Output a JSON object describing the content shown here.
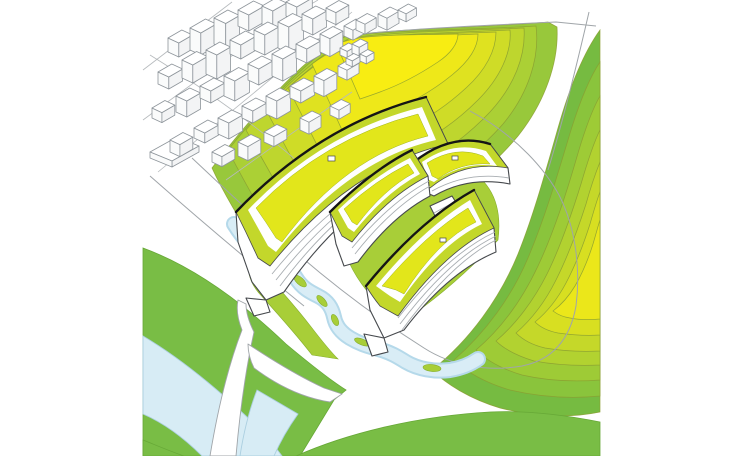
{
  "meta": {
    "title": "Architectural site-plan illustration",
    "description": "Axonometric diagram of four curved slab buildings with yellow-green roofs on a white plaza, set between two contoured hills, a small town, a winding creek and a branching riverside park",
    "visible_text": []
  },
  "scene": {
    "regions": [
      {
        "name": "town",
        "label": "white low-rise town blocks, upper left"
      },
      {
        "name": "north-hill",
        "label": "contoured hill, yellow peak fading to green"
      },
      {
        "name": "east-hill",
        "label": "contoured hill on the right, green edge to yellow peak"
      },
      {
        "name": "campus",
        "label": "four curved slab buildings with striped facades and chartreuse roofs"
      },
      {
        "name": "creek",
        "label": "winding light-blue creek with small green islands"
      },
      {
        "name": "river",
        "label": "wide light-blue river band, lower left"
      },
      {
        "name": "park",
        "label": "flat green park bands along roads"
      },
      {
        "name": "road-junction",
        "label": "white Y-shaped road branching through the park"
      }
    ]
  },
  "colors": {
    "canvasBg": "#ffffff",
    "outlineGray": "#a0a5a9",
    "outlineDark": "#46494d",
    "ridgeBlack": "#151515",
    "stripeGray": "#a8adb1",
    "townStroke": "#8e959b",
    "townLine": "#b6babd",
    "contourStroke": "#8a9e31",
    "hillN0": "#98c83b",
    "hillN1": "#abd035",
    "hillN2": "#bed62e",
    "hillN3": "#cfdc27",
    "hillN4": "#dfe220",
    "hillN5": "#eee819",
    "hillN6": "#f8ed12",
    "hillE0": "#76bb41",
    "hillE1": "#8ac43c",
    "hillE2": "#9ecb36",
    "hillE3": "#b2d230",
    "hillE4": "#c5d829",
    "hillE5": "#d8df21",
    "hillE6": "#ebe71a",
    "parkGreen": "#79bd45",
    "parkGreenEdge": "#67a837",
    "lawnChartreuse": "#a8ce38",
    "lawnEdge": "#86ae2e",
    "riverBlue": "#d7ecf5",
    "riverEdge": "#abcfe0",
    "streamBlue": "#d9edf6",
    "streamEdge": "#b5d9ea",
    "roofRim": "#c3d72b",
    "roofPanel": "#e2e61b",
    "panelEdge": "#9fb423"
  }
}
